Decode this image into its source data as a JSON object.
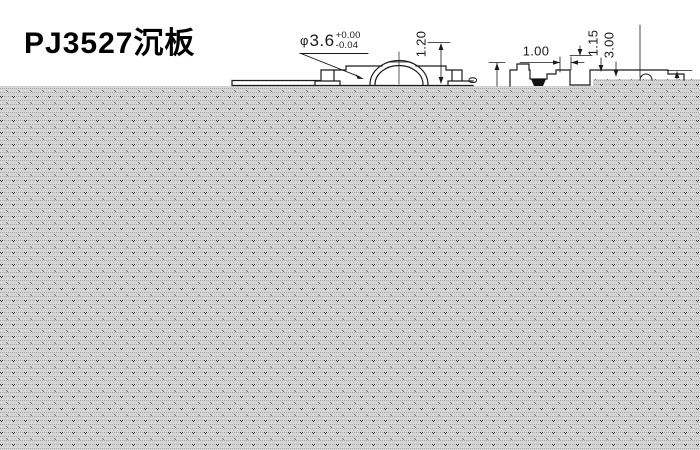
{
  "title": "PJ3527沉板",
  "colors": {
    "background": "#ffffff",
    "line": "#1a1a1a",
    "pattern_base": "#d6d6d6",
    "pattern_dot": "#a2a2a2",
    "pattern_dark": "#2f2f2f"
  },
  "front_view": {
    "diameter_label": {
      "prefix": "φ",
      "value": "3.6",
      "tol_upper": "+0.00",
      "tol_lower": "-0.04"
    },
    "height_label": "1.20"
  },
  "side_view": {
    "width_label": "1.00",
    "depth_label": "1.15",
    "length_label": "3.00",
    "partial_label": "0"
  }
}
